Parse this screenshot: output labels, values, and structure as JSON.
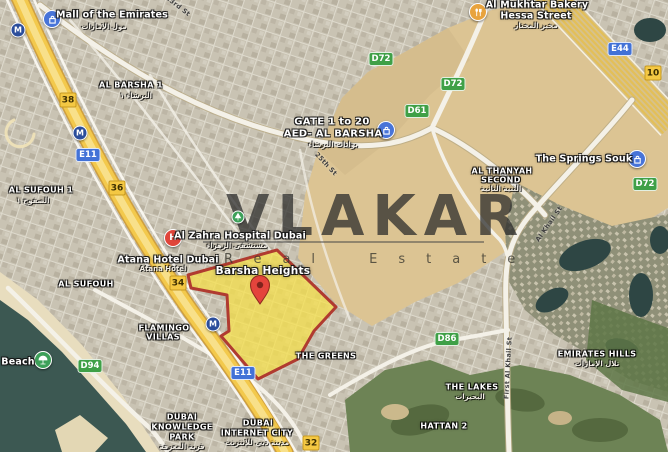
{
  "watermark": {
    "brand": "VLAKAR",
    "subtitle": "Real Estate"
  },
  "highlight": {
    "label": "Barsha Heights"
  },
  "poi": {
    "mall": {
      "name": "Mall of the Emirates",
      "ar": "مول الإمارات"
    },
    "bakery": {
      "line1": "Al Mukhtar Bakery",
      "line2": "Hessa Street",
      "ar": "مخبز المختار"
    },
    "springs_souk": {
      "name": "The Springs Souk"
    },
    "hospital": {
      "name": "Al Zahra Hospital Dubai",
      "ar": "مستشفى الزهراء"
    },
    "hotel": {
      "name": "Atana Hotel Dubai",
      "sub": "Atana Hotel"
    },
    "beach": {
      "name": "Beach"
    }
  },
  "districts": {
    "al_barsha_1": {
      "name": "AL BARSHA 1",
      "ar": "البرشاء ١"
    },
    "gate": {
      "line1": "GATE 1 to 20",
      "line2": "AED- AL BARSHA",
      "ar": "بوابات البرشاء"
    },
    "al_sufouh_1": {
      "name": "AL SUFOUH 1",
      "ar": "الصفوح ١"
    },
    "al_sufouh": {
      "name": "AL SUFOUH"
    },
    "al_thanyah": {
      "line1": "AL THANYAH",
      "line2": "SECOND",
      "ar": "الثنية الثانية"
    },
    "flamingo": {
      "line1": "FLAMINGO",
      "line2": "VILLAS"
    },
    "the_greens": {
      "name": "THE GREENS"
    },
    "emirates_hills": {
      "name": "EMIRATES HILLS",
      "ar": "تلال الإمارات"
    },
    "the_lakes": {
      "name": "THE LAKES",
      "ar": "البحيرات"
    },
    "hattan_2": {
      "name": "HATTAN 2"
    },
    "knowledge_park": {
      "line1": "DUBAI",
      "line2": "KNOWLEDGE",
      "line3": "PARK",
      "ar": "قرية المعرفة"
    },
    "internet_city": {
      "line1": "DUBAI",
      "line2": "INTERNET CITY",
      "ar": "مدينة دبي للإنترنت"
    }
  },
  "badges": {
    "e11": "E11",
    "e44": "E44",
    "d72": "D72",
    "d61": "D61",
    "d86": "D86",
    "d94": "D94",
    "exit_38": "38",
    "exit_36": "36",
    "exit_34": "34",
    "exit_32": "32",
    "exit_10": "10"
  },
  "streets": {
    "st_23": "23rd St",
    "st_25": "25th St",
    "al_khail": "Al Khail St",
    "first_al_khail": "First Al Khail St"
  },
  "icon_glyphs": {
    "metro": "M",
    "hospital": "H"
  },
  "colors": {
    "highlight_fill": "#F7E146",
    "highlight_border": "#B03B30",
    "route_blue": "#4272D7",
    "route_green": "#3FA047",
    "exit_yellow": "#F4C843",
    "pin_red": "#E4443C"
  }
}
